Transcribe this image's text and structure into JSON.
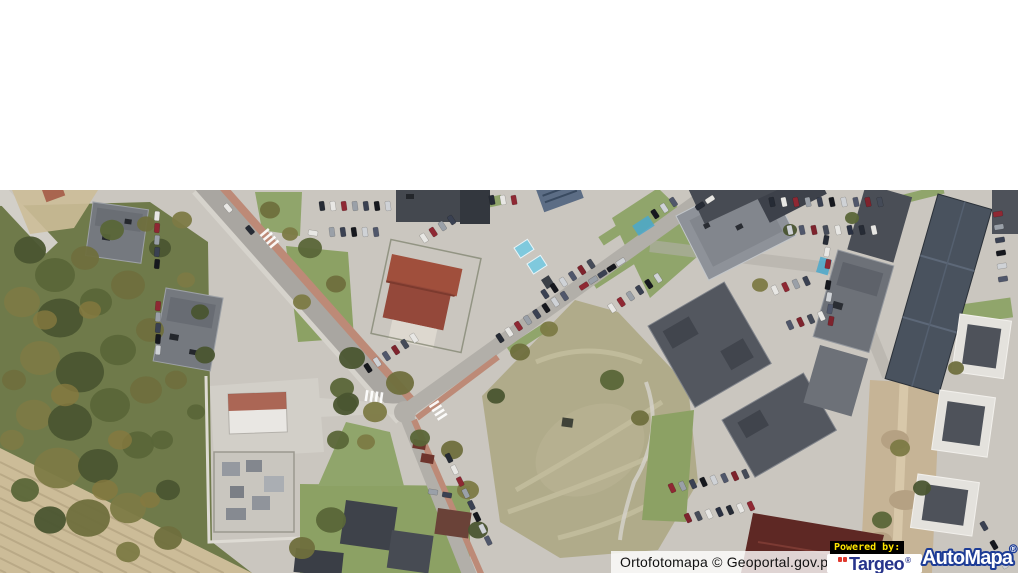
{
  "window": {
    "background": "#ffffff"
  },
  "map_overlay": {
    "attribution_text": "Ortofotomapa © Geoportal.gov.pl",
    "powered_by_label": "Powered by:",
    "targeo_brand": "Targeo",
    "targeo_registered_mark": "®",
    "automapa_brand": "AutoMapa",
    "automapa_registered_mark": "®"
  },
  "brand_colors": {
    "targeo_blue": "#27348b",
    "targeo_red": "#e0392e",
    "automapa_fill": "#ffffff",
    "automapa_outline": "#1d3c96",
    "powered_by_yellow": "#ffe600",
    "powered_by_bg": "#000000",
    "attribution_bg": "rgba(255,255,255,0.8)",
    "attribution_text_color": "#111111"
  },
  "map_palette": {
    "pavement": "#cac6bf",
    "asphalt": "#a9a6a1",
    "asphalt_light": "#b2afa9",
    "brick": "#bd8a77",
    "sidewalk": "#d6d3cc",
    "grass": "#8ca164",
    "grass_bright": "#90a56b",
    "field": "#b0ab8a",
    "field_light": "#c3bd9e",
    "plow": "#ccbc98",
    "plow_line": "#b5a483",
    "green_base": "#6f7a4a",
    "tree1": "#4a5530",
    "tree2": "#5a6638",
    "tree3": "#6f6f3d",
    "tree4": "#7c7a45",
    "autumn": "#86793f",
    "roof_dark": "#44484f",
    "roof_mid": "#53575f",
    "roof_gray": "#75797f",
    "roof_light": "#8e9299",
    "roof_white": "#e4e2dd",
    "roof_red": "#a04f3c",
    "roof_maroon": "#5e2824",
    "dirt": "#c6b496",
    "white_wall": "#e9e7e3",
    "concrete": "#d2cfc8"
  }
}
